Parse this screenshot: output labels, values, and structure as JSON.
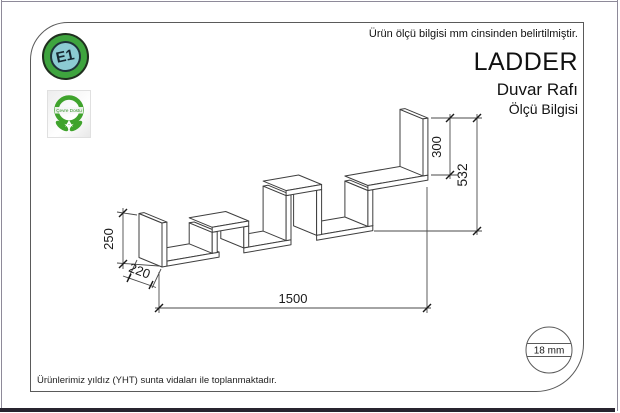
{
  "sheet": {
    "top_note": "Ürün ölçü bilgisi mm cinsinden belirtilmiştir.",
    "bottom_note": "Ürünlerimiz yıldız (YHT) sunta vidaları ile toplanmaktadır."
  },
  "title_block": {
    "product": "LADDER",
    "type": "Duvar Rafı",
    "sheet": "Ölçü Bilgisi"
  },
  "badges": {
    "e1": "E1",
    "eco": "Çevre Dostu"
  },
  "dimensions": {
    "left_height": "250",
    "depth": "220",
    "width": "1500",
    "right_panel_height": "300",
    "total_height": "532",
    "thickness": "18 mm"
  },
  "colors": {
    "accent_green": "#3EA43E",
    "badge_blue": "#8CCBD2",
    "line": "#4A4A4A"
  }
}
